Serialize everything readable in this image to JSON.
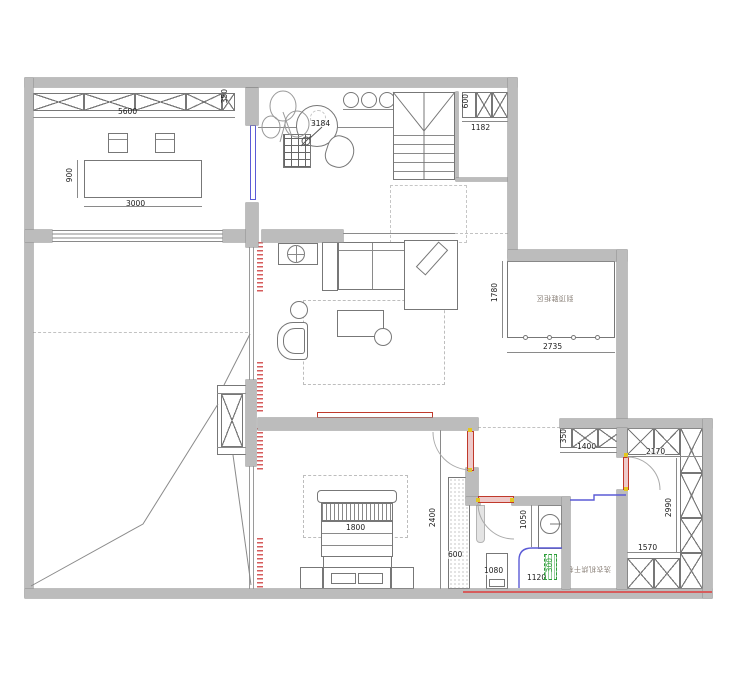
{
  "dims": {
    "top_cabinet_length": "5600",
    "top_cabinet_depth": "350",
    "round_table": "3184",
    "shaft_cabinet_depth": "600",
    "shaft_width": "1182",
    "dining_table_depth": "900",
    "dining_table_length": "3000",
    "entry_zone_depth": "1780",
    "entry_zone_width": "2735",
    "closet_strip_depth": "350",
    "closet_strip_length": "1400",
    "closet_top_length": "2170",
    "closet_side_length": "2990",
    "closet_bottom_length": "1570",
    "bed_width": "1800",
    "bedroom_depth": "2400",
    "wardrobe_width": "600",
    "basin_counter_length": "1050",
    "toilet_zone_width": "1080",
    "bath_zone_width": "1120",
    "drain_offset": "300"
  },
  "notes": {
    "entry_cabinet": "到顶鞋柜区",
    "laundry": "洗衣机烘干机"
  },
  "colors": {
    "wall": "#bcbcbc",
    "line": "#777777",
    "red": "#c0392b",
    "blue": "#5b5bd6",
    "green": "#2e9e3a",
    "hinge_yellow": "#e4c71f"
  }
}
